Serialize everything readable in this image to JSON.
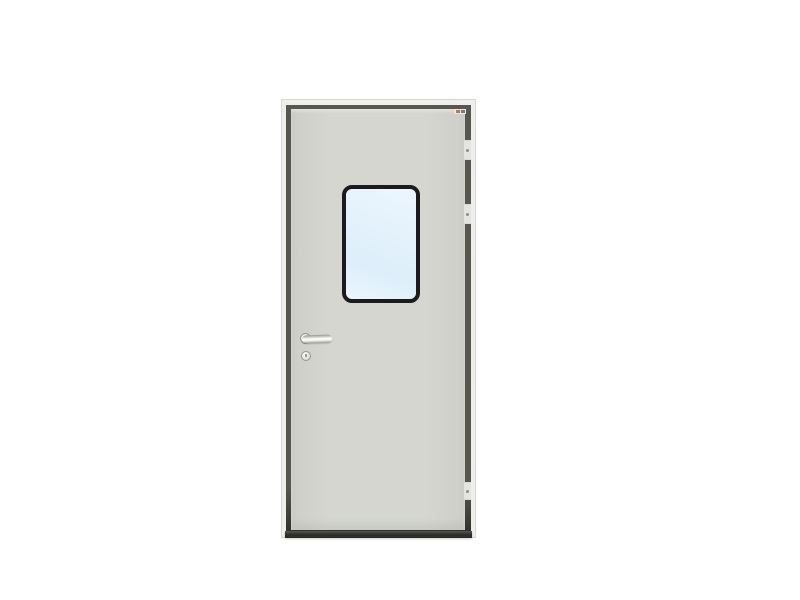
{
  "image": {
    "type": "product-photo",
    "subject": "gray steel door with rounded vision window, lever handle, keyhole escutcheon and three right-edge hinges on a white background"
  },
  "parts": [
    "door-frame",
    "door-reveal-gap",
    "door-leaf",
    "brand-label",
    "vision-window",
    "window-glass",
    "handle-rose",
    "lever-handle",
    "keyhole-escutcheon",
    "hinge-top",
    "hinge-upper-middle",
    "hinge-bottom",
    "door-bottom-shadow"
  ],
  "colors": {
    "background": "#ffffff",
    "frame": "#eeeeea",
    "frame_border": "#d8d8d4",
    "reveal": "#57574f",
    "reveal_dark": "#2c2c28",
    "leaf": "#d5d6d0",
    "leaf_dark": "#cdcec8",
    "window_frame": "#1b1b1b",
    "glass": "#ddeefa",
    "glass_light": "#ecf6fe",
    "metal_light": "#fafaf8",
    "metal_mid": "#d7d7d3",
    "metal_dark": "#97978f",
    "hinge": "#e4e4e0",
    "hinge_dot": "#8f8f89",
    "label_bg": "#e8e8e4",
    "label_orange": "#b97a44",
    "label_slate": "#6e7e8c"
  }
}
